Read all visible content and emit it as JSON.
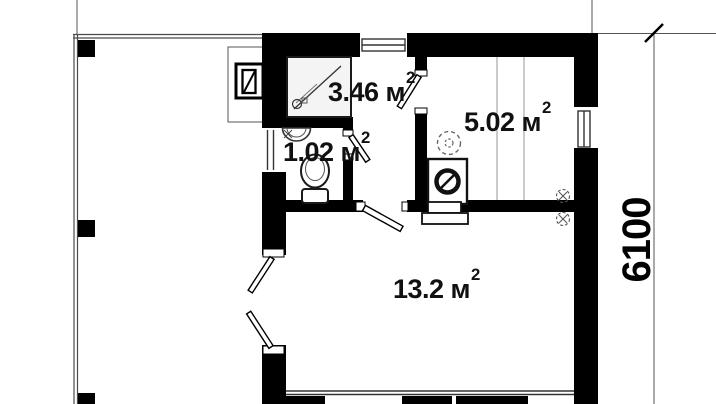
{
  "rooms": [
    {
      "id": "shower",
      "area": "3.46 м",
      "sup": "2"
    },
    {
      "id": "wc",
      "area": "1.02 м",
      "sup": "2"
    },
    {
      "id": "sauna",
      "area": "5.02 м",
      "sup": "2"
    },
    {
      "id": "living",
      "area": "13.2 м",
      "sup": "2"
    }
  ],
  "dimension": {
    "value": "6100"
  },
  "colors": {
    "wall": "#000000",
    "thin_line": "#555555",
    "background": "#ffffff"
  },
  "icons": [
    "shower-cabin-icon",
    "washbasin-icon",
    "toilet-icon",
    "stove-icon",
    "vent-icon",
    "fan-icon",
    "boiler-icon",
    "window-icon",
    "door-leaf-icon",
    "terrace-post-icon",
    "dimension-tick-icon"
  ]
}
